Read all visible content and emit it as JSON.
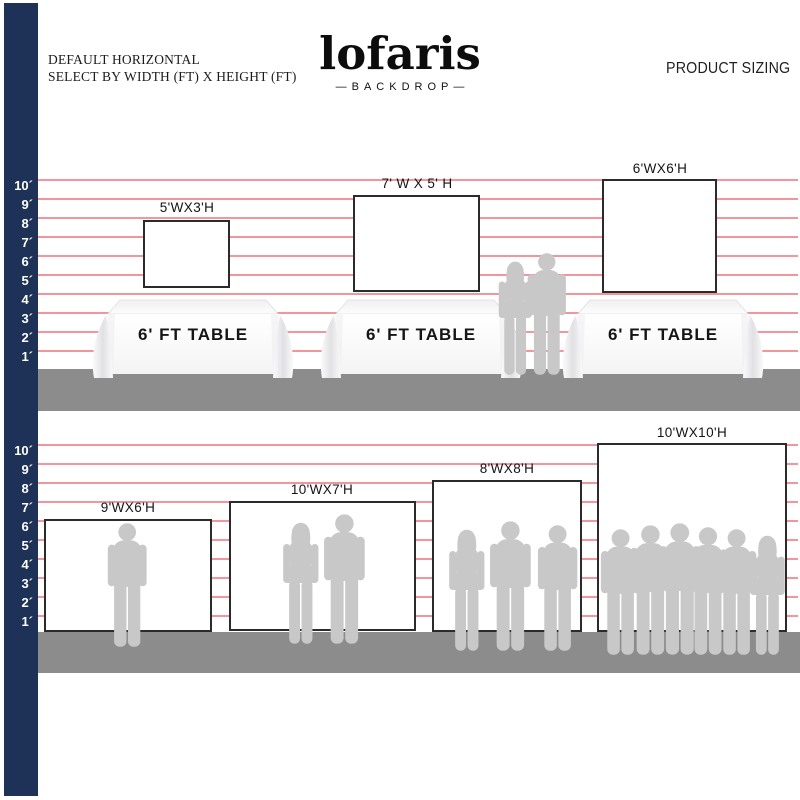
{
  "header": {
    "line1": "DEFAULT HORIZONTAL",
    "line2": "SELECT BY WIDTH (FT) X HEIGHT (FT)",
    "brand": "lofaris",
    "brand_tagline": "—BACKDROP—",
    "product_sizing": "PRODUCT SIZING"
  },
  "ruler": {
    "labels": [
      "10´",
      "9´",
      "8´",
      "7´",
      "6´",
      "5´",
      "4´",
      "3´",
      "2´",
      "1´"
    ]
  },
  "top_section": {
    "backdrops": [
      {
        "label": "5'WX3'H",
        "width_ft": 5,
        "height_ft": 3
      },
      {
        "label": "7' W X 5' H",
        "width_ft": 7,
        "height_ft": 5
      },
      {
        "label": "6'WX6'H",
        "width_ft": 6,
        "height_ft": 6
      }
    ],
    "tables": [
      {
        "label": "6' FT TABLE"
      },
      {
        "label": "6' FT TABLE"
      },
      {
        "label": "6' FT TABLE"
      }
    ]
  },
  "bottom_section": {
    "backdrops": [
      {
        "label": "9'WX6'H",
        "width_ft": 9,
        "height_ft": 6
      },
      {
        "label": "10'WX7'H",
        "width_ft": 10,
        "height_ft": 7
      },
      {
        "label": "8'WX8'H",
        "width_ft": 8,
        "height_ft": 8
      },
      {
        "label": "10'WX10'H",
        "width_ft": 10,
        "height_ft": 10
      }
    ]
  },
  "colors": {
    "navy": "#1e3156",
    "gridline_pink": "#f2959d",
    "floor_gray": "#8c8c8c",
    "silhouette_gray": "#c8c8c8"
  }
}
